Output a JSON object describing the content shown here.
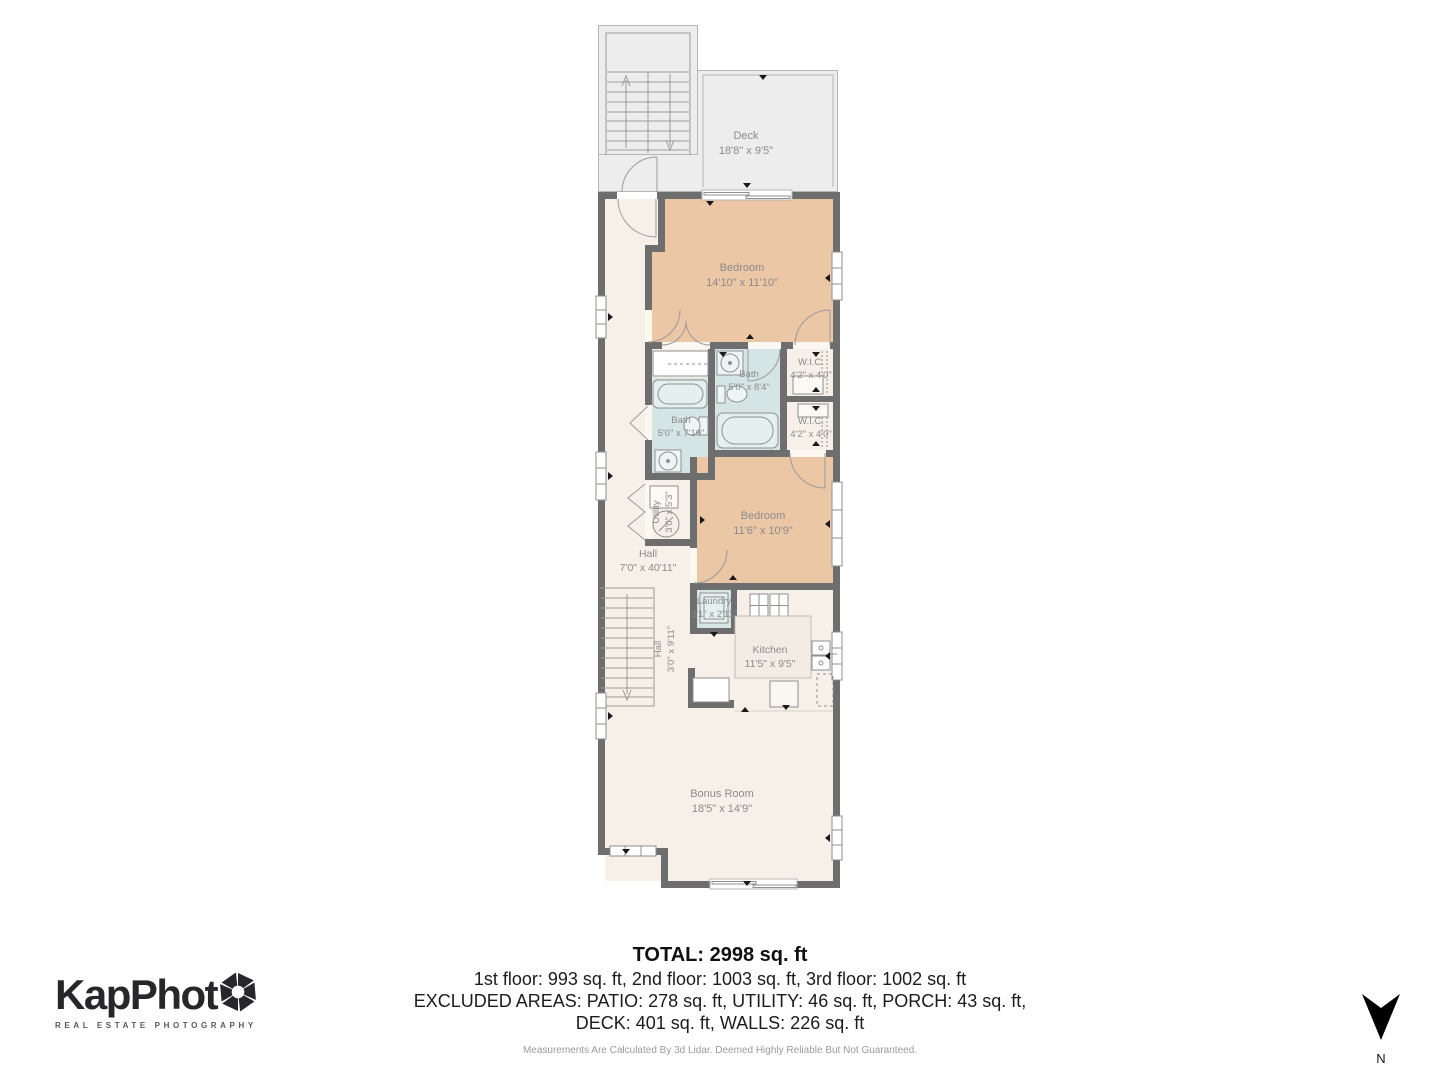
{
  "plan": {
    "rooms": {
      "deck": {
        "name": "Deck",
        "dims": "18'8\" x 9'5\""
      },
      "bedroom_upper": {
        "name": "Bedroom",
        "dims": "14'10\" x 11'10\""
      },
      "bath_ensuite": {
        "name": "Bath",
        "dims": "5'0\" x 8'4\""
      },
      "wic_1": {
        "name": "W.I.C.",
        "dims": "4'2\" x 4'0\""
      },
      "wic_2": {
        "name": "W.I.C.",
        "dims": "4'2\" x 4'0\""
      },
      "bath_hall": {
        "name": "Bath",
        "dims": "5'0\" x 7'10\""
      },
      "bedroom_lower": {
        "name": "Bedroom",
        "dims": "11'6\" x 10'9\""
      },
      "utility": {
        "name": "Utility",
        "dims": "3'0\" x 5'3\""
      },
      "hall": {
        "name": "Hall",
        "dims": "7'0\" x 40'11\""
      },
      "laundry": {
        "name": "Laundry",
        "dims": "3'1\" x 2'11\""
      },
      "kitchen": {
        "name": "Kitchen",
        "dims": "11'5\" x 9'5\""
      },
      "hall_stairs": {
        "name": "Hall",
        "dims": "3'0\" x 9'11\""
      },
      "bonus_room": {
        "name": "Bonus Room",
        "dims": "18'5\" x 14'9\""
      }
    },
    "colors": {
      "wall": "#6e6e6e",
      "floor": "#f6f0e8",
      "bedroom": "#ebc7a6",
      "bath": "#d5e4e5",
      "deck": "#ededed",
      "label_text": "#8b8b8b"
    }
  },
  "footer": {
    "total": "TOTAL: 2998 sq. ft",
    "floors": "1st floor: 993 sq. ft, 2nd floor: 1003 sq. ft, 3rd floor: 1002 sq. ft",
    "excluded_line1": "EXCLUDED AREAS: PATIO: 278 sq. ft, UTILITY: 46 sq. ft, PORCH: 43 sq. ft,",
    "excluded_line2": "DECK: 401 sq. ft, WALLS: 226 sq. ft",
    "disclaimer": "Measurements Are Calculated By 3d Lidar. Deemed Highly Reliable But Not Guaranteed."
  },
  "logo": {
    "wordmark": "KapPhot",
    "tagline": "REAL ESTATE PHOTOGRAPHY"
  },
  "compass": {
    "label": "N"
  }
}
